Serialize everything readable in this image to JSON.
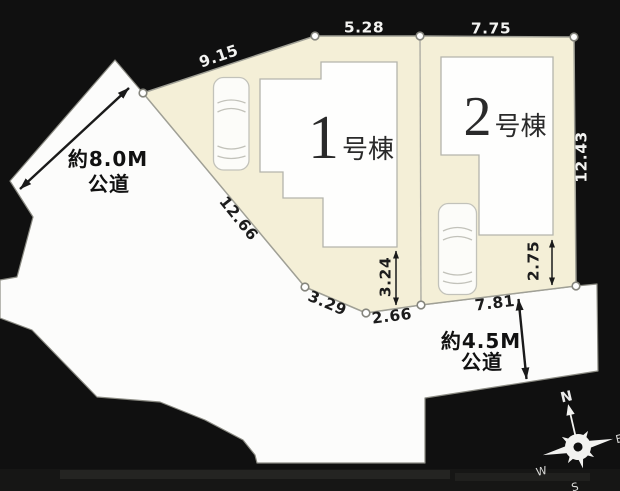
{
  "site_plan": {
    "dimensions": {
      "d9_15": "9.15",
      "d5_28": "5.28",
      "d7_75": "7.75",
      "d12_43": "12.43",
      "d12_66": "12.66",
      "d3_29": "3.29",
      "d2_66": "2.66",
      "d7_81": "7.81",
      "d3_24": "3.24",
      "d2_75": "2.75"
    },
    "roads": {
      "west": {
        "width_label": "約8.0M",
        "type_label": "公道"
      },
      "south": {
        "width_label": "約4.5M",
        "type_label": "公道"
      }
    },
    "buildings": {
      "b1": {
        "number": "1",
        "suffix": "号棟"
      },
      "b2": {
        "number": "2",
        "suffix": "号棟"
      }
    },
    "compass": {
      "north": "N",
      "east": "E",
      "south": "S",
      "west": "W"
    },
    "colors": {
      "background": "#101010",
      "road_fill": "#fcfcfb",
      "lot_fill": "#f4efd7",
      "boundary_line": "#9a9a90",
      "dimension_text_dark": "#1c1c1c",
      "dimension_text_light": "#f3f3f1"
    }
  }
}
